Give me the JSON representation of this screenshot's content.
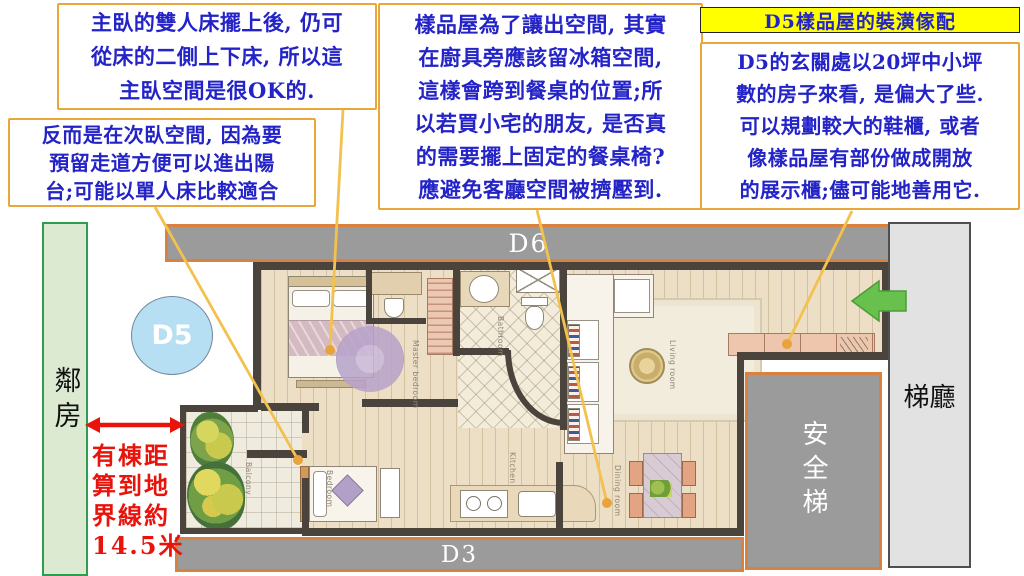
{
  "annotations": {
    "box_master": {
      "lines": [
        "主臥的雙人床擺上後, 仍可",
        "從床的二側上下床, 所以這",
        "主臥空間是很OK的."
      ]
    },
    "box_second": {
      "lines": [
        "反而是在次臥空間, 因為要",
        "預留走道方便可以進出陽",
        "台;可能以單人床比較適合"
      ]
    },
    "box_kitchen": {
      "lines": [
        "樣品屋為了讓出空間, 其實",
        "在廚具旁應該留冰箱空間,",
        "這樣會跨到餐桌的位置;所",
        "以若買小宅的朋友, 是否真",
        "的需要擺上固定的餐桌椅?",
        "應避免客廳空間被擠壓到."
      ]
    },
    "title": "D5樣品屋的裝潢傢配",
    "box_entry": {
      "lines": [
        "D5的玄關處以20坪中小坪",
        "數的房子來看, 是偏大了些.",
        "可以規劃較大的鞋櫃, 或者",
        "像樣品屋有部份做成開放",
        "的展示櫃;儘可能地善用它."
      ]
    },
    "distance_note": {
      "lines": [
        "有棟距",
        "算到地",
        "界線約",
        "14.5米"
      ]
    }
  },
  "labels": {
    "neighbor": "鄰房",
    "elevator_hall": "梯廳",
    "fire_stairs": "安全梯",
    "unit_badge": "D5",
    "unit_top": "D6",
    "unit_bottom": "D3"
  },
  "floorplan": {
    "rooms": {
      "master": "Master bedroom",
      "bathroom": "Bathroom",
      "balcony": "Balcony",
      "bedroom": "Bedroom",
      "kitchen": "Kitchen",
      "living": "Living room",
      "dining": "Dining room"
    }
  },
  "colors": {
    "annotation_border": "#E9A63B",
    "text_blue": "#2323C8",
    "highlight_yellow": "#FFFF00",
    "corridor_orange": "#D9813F",
    "corridor_gray": "#9B9B9B",
    "neighbor_green": "#2E9E4E",
    "alert_red": "#E8140C",
    "entry_arrow_green": "#68C14C",
    "callout_line": "#F2C14E",
    "badge_blue": "#B6DFF4"
  }
}
